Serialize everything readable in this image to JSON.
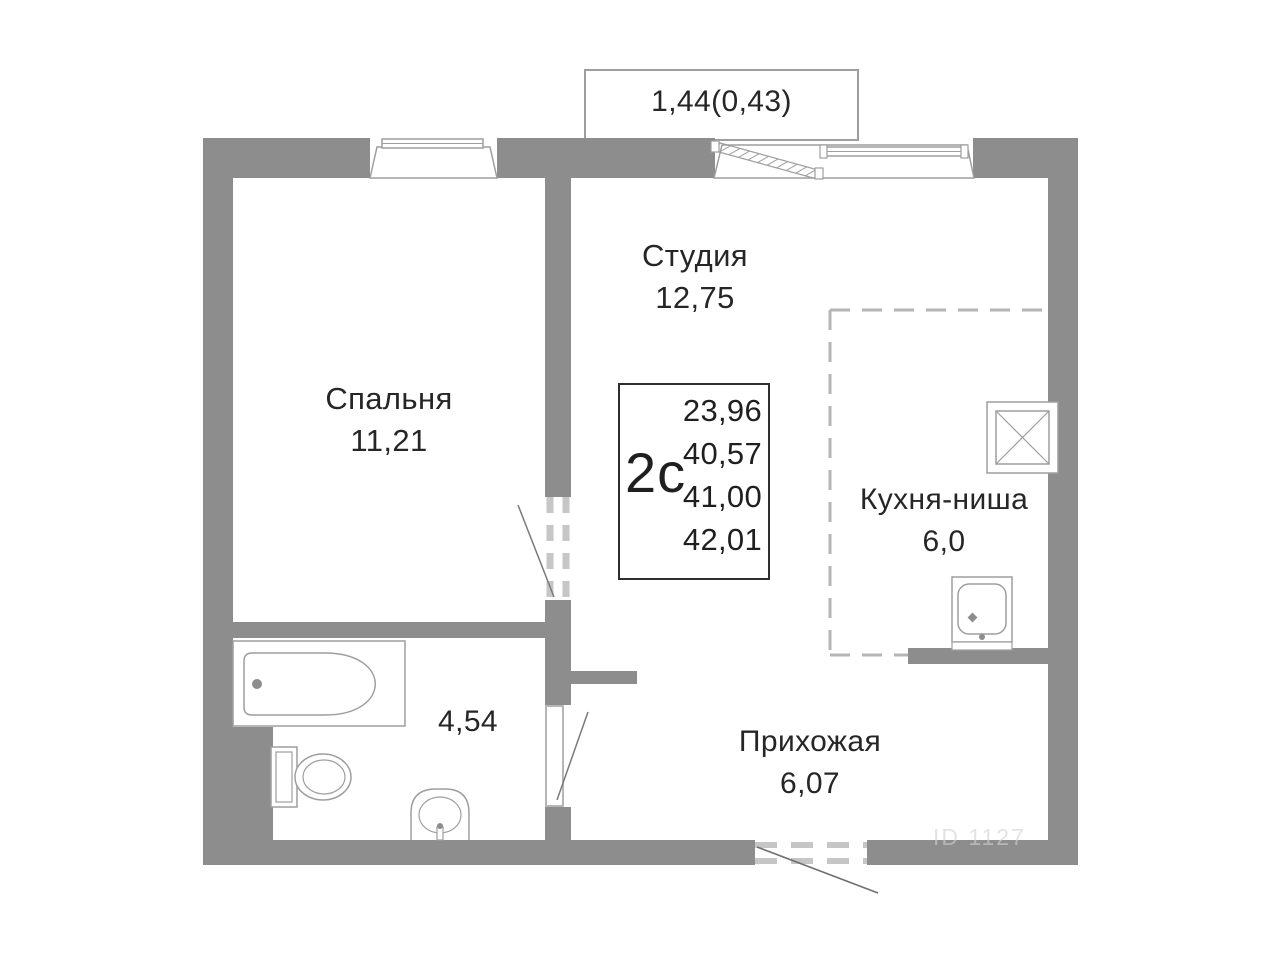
{
  "plan": {
    "balcony_label": "1,44(0,43)",
    "rooms": [
      {
        "name": "Спальня",
        "area": "11,21"
      },
      {
        "name": "Студия",
        "area": "12,75"
      },
      {
        "name": "Кухня-ниша",
        "area": "6,0"
      },
      {
        "name": "Прихожая",
        "area": "6,07"
      }
    ],
    "bathroom_area": "4,54",
    "info_box": {
      "type_label": "2с",
      "values": [
        "23,96",
        "40,57",
        "41,00",
        "42,01"
      ]
    },
    "watermark": "ID 1127",
    "colors": {
      "wall": "#8d8d8d",
      "fixture_line": "#9e9e9e",
      "dash_line": "#c6c6c6",
      "swing_line": "#7a7a7a",
      "info_border": "#2e2e2e",
      "text": "#262626"
    }
  }
}
